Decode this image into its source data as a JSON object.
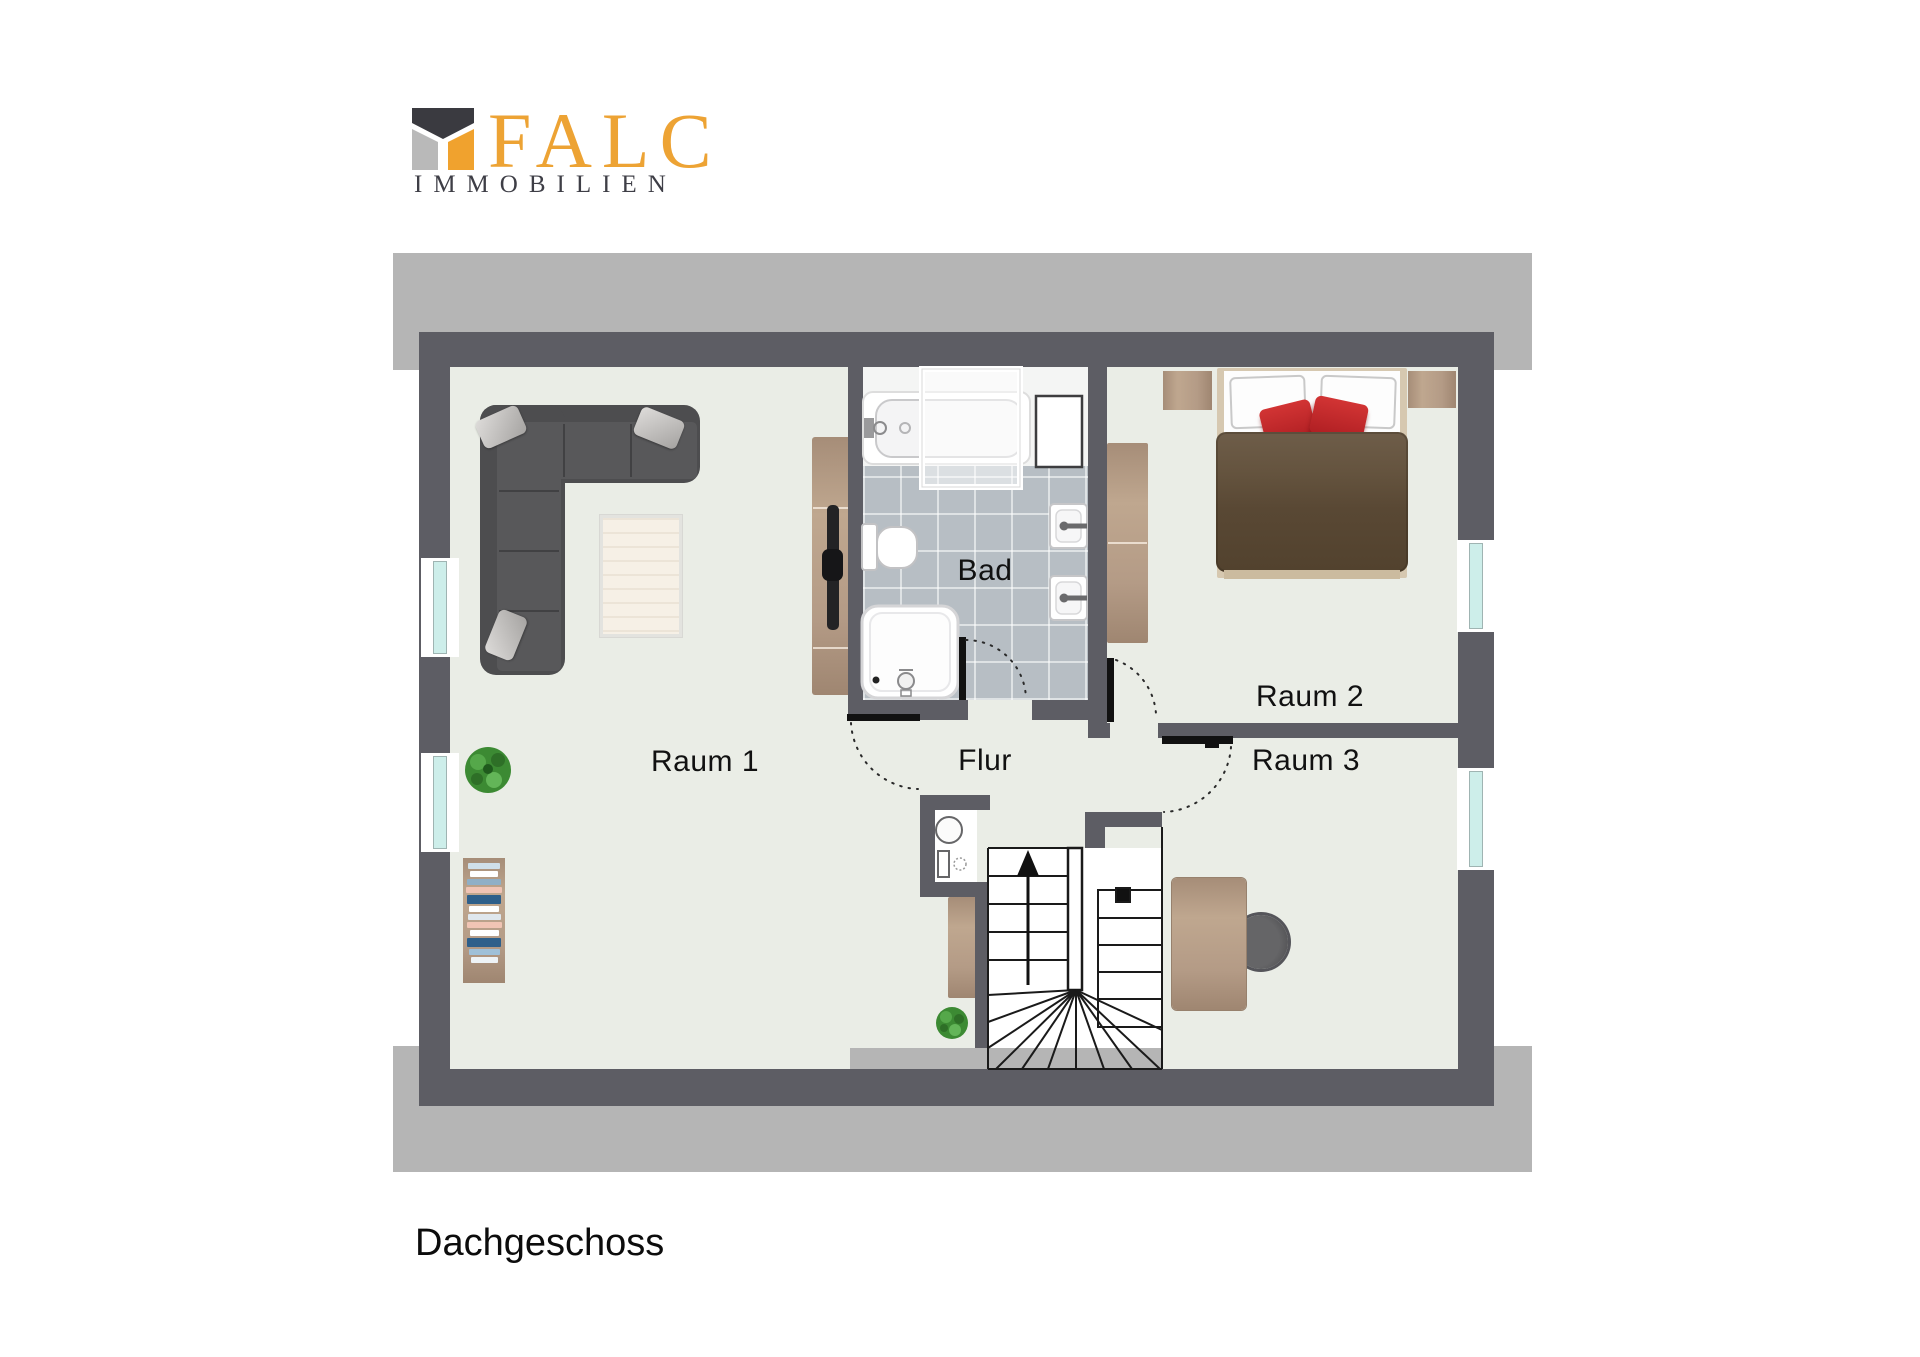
{
  "brand": {
    "name": "FALC",
    "subtitle": "IMMOBILIEN"
  },
  "plan": {
    "caption": "Dachgeschoss",
    "labels": {
      "room1": "Raum 1",
      "room2": "Raum 2",
      "room3": "Raum 3",
      "bath": "Bad",
      "hall": "Flur"
    },
    "colors": {
      "brand_orange": "#f0a22e",
      "brand_dark": "#3e3e46",
      "wall": "#5d5d64",
      "roof_band": "#b5b5b5",
      "floor": "#eaede6",
      "bath_tile": "#b7bec4",
      "wood": "#b49b86",
      "bed_blanket": "#5d4c38",
      "accent_red": "#c4262a",
      "window_glass": "#cdeeea"
    }
  }
}
